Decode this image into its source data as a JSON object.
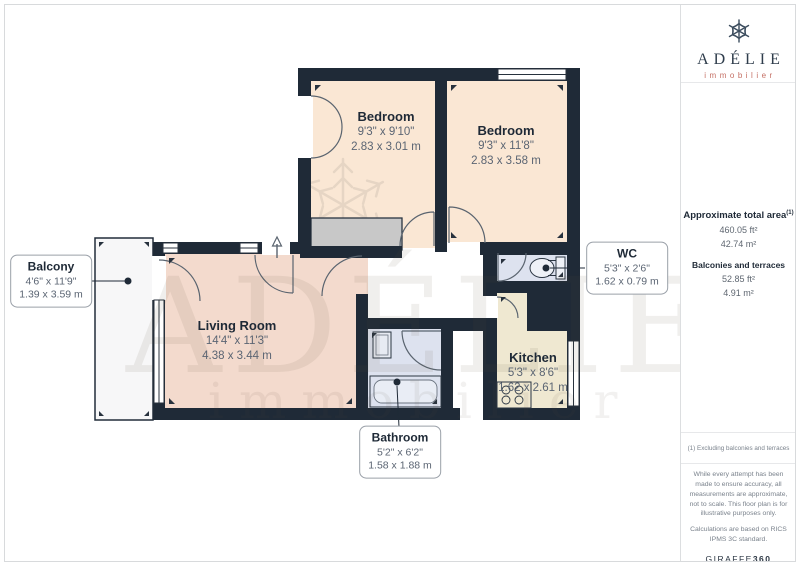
{
  "plan": {
    "rooms": {
      "bedroom1": {
        "name": "Bedroom",
        "imperial": "9'3\" x 9'10\"",
        "metric": "2.83 x 3.01 m"
      },
      "bedroom2": {
        "name": "Bedroom",
        "imperial": "9'3\" x 11'8\"",
        "metric": "2.83 x 3.58 m"
      },
      "wc": {
        "name": "WC",
        "imperial": "5'3\" x 2'6\"",
        "metric": "1.62 x 0.79 m"
      },
      "kitchen": {
        "name": "Kitchen",
        "imperial": "5'3\" x 8'6\"",
        "metric": "1.62 x 2.61 m"
      },
      "living_room": {
        "name": "Living Room",
        "imperial": "14'4\" x 11'3\"",
        "metric": "4.38 x 3.44 m"
      },
      "balcony": {
        "name": "Balcony",
        "imperial": "4'6\" x 11'9\"",
        "metric": "1.39 x 3.59 m"
      },
      "bathroom": {
        "name": "Bathroom",
        "imperial": "5'2\" x 6'2\"",
        "metric": "1.58 x 1.88 m"
      }
    },
    "watermark": {
      "title": "ADÉLIE",
      "subtitle": "immobilier"
    },
    "colors": {
      "wall": "#1f2a37",
      "bedroom_fill": "#fae7d4",
      "living_fill": "#f3dacd",
      "kitchen_fill": "#efe8d1",
      "wet_room_fill": "#dde2ef",
      "balcony_fill": "#f7f7f8",
      "closet_fill": "#c8c8c8",
      "logo_accent": "#c57065"
    }
  },
  "sidebar": {
    "logo": {
      "name": "ADÉLIE",
      "tagline": "immobilier"
    },
    "area": {
      "total_label": "Approximate total area",
      "total_footnote_ref": "(1)",
      "total_ft": "460.05 ft²",
      "total_m": "42.74 m²",
      "balconies_label": "Balconies and terraces",
      "balconies_ft": "52.85 ft²",
      "balconies_m": "4.91 m²"
    },
    "footnote": "(1) Excluding balconies and terraces",
    "disclaimer": "While every attempt has been made to ensure accuracy, all measurements are approximate, not to scale. This floor plan is for illustrative purposes only.",
    "calculations": "Calculations are based on RICS IPMS 3C standard.",
    "brand": {
      "giraffe": "GIRAFFE",
      "three_sixty": "360"
    }
  }
}
